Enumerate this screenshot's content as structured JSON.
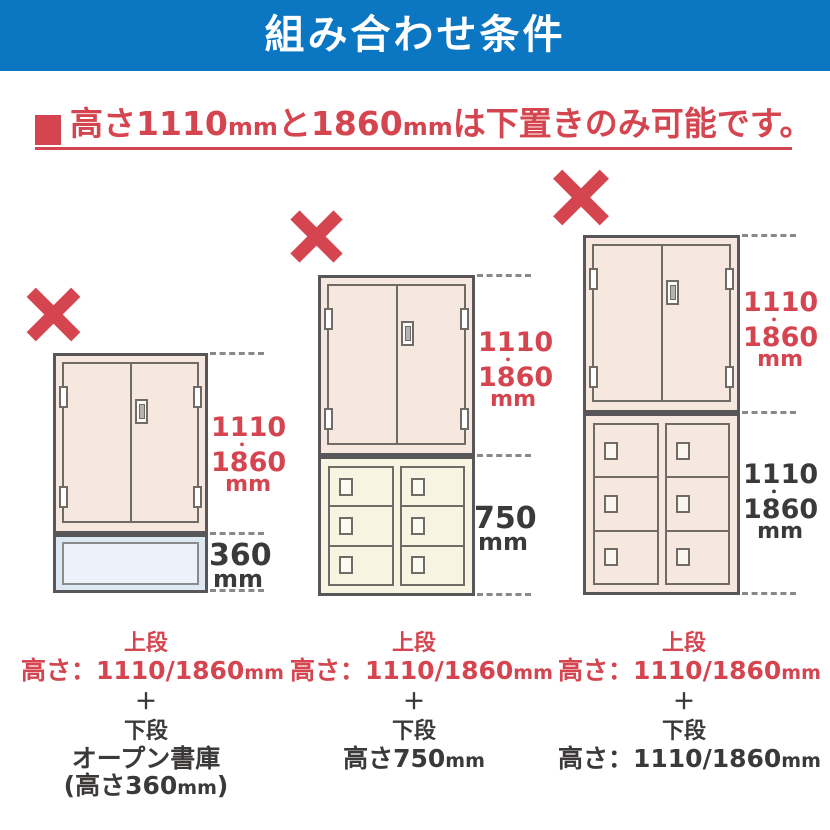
{
  "header": {
    "title": "組み合わせ条件"
  },
  "notice": {
    "segments": {
      "a": "高さ1110",
      "a_unit": "mm",
      "b": "と1860",
      "b_unit": "mm",
      "c": "は下置きのみ可能です。"
    }
  },
  "diagrams": [
    {
      "name": "tall-cabinet-on-open-shelf",
      "mark": "x",
      "upper_dim": {
        "v1": "1110",
        "dot": "・",
        "v2": "1860",
        "unit": "mm"
      },
      "lower_dim": {
        "v1": "360",
        "unit": "mm"
      },
      "caption": {
        "upper_label": "上段",
        "upper_height": "高さ：1110/1860",
        "upper_height_unit": "mm",
        "plus": "＋",
        "lower_label": "下段",
        "lower_name": "オープン書庫",
        "lower_height_open": "(高さ360",
        "lower_height_unit": "mm",
        "lower_height_close": ")"
      }
    },
    {
      "name": "tall-cabinet-on-750-locker",
      "mark": "x",
      "upper_dim": {
        "v1": "1110",
        "dot": "・",
        "v2": "1860",
        "unit": "mm"
      },
      "lower_dim": {
        "v1": "750",
        "unit": "mm"
      },
      "caption": {
        "upper_label": "上段",
        "upper_height": "高さ：1110/1860",
        "upper_height_unit": "mm",
        "plus": "＋",
        "lower_label": "下段",
        "lower_height": "高さ750",
        "lower_height_unit": "mm"
      }
    },
    {
      "name": "tall-cabinet-on-tall-locker",
      "mark": "x",
      "upper_dim": {
        "v1": "1110",
        "dot": "・",
        "v2": "1860",
        "unit": "mm"
      },
      "lower_dim": {
        "v1": "1110",
        "dot": "・",
        "v2": "1860",
        "unit": "mm"
      },
      "caption": {
        "upper_label": "上段",
        "upper_height": "高さ：1110/1860",
        "upper_height_unit": "mm",
        "plus": "＋",
        "lower_label": "下段",
        "lower_height": "高さ：1110/1860",
        "lower_height_unit": "mm"
      }
    }
  ],
  "colors": {
    "header_bg": "#0b76c2",
    "accent_red": "#d5454f",
    "cabinet_pink": "#f6e8de",
    "locker_cream": "#f7f5e1",
    "shelf_blue": "#dce8f3",
    "shelf_blue_inner": "#ebf2f9",
    "outline_dark": "#59565a",
    "text_dark": "#3c3a39",
    "dash_gray": "#8a8888"
  }
}
